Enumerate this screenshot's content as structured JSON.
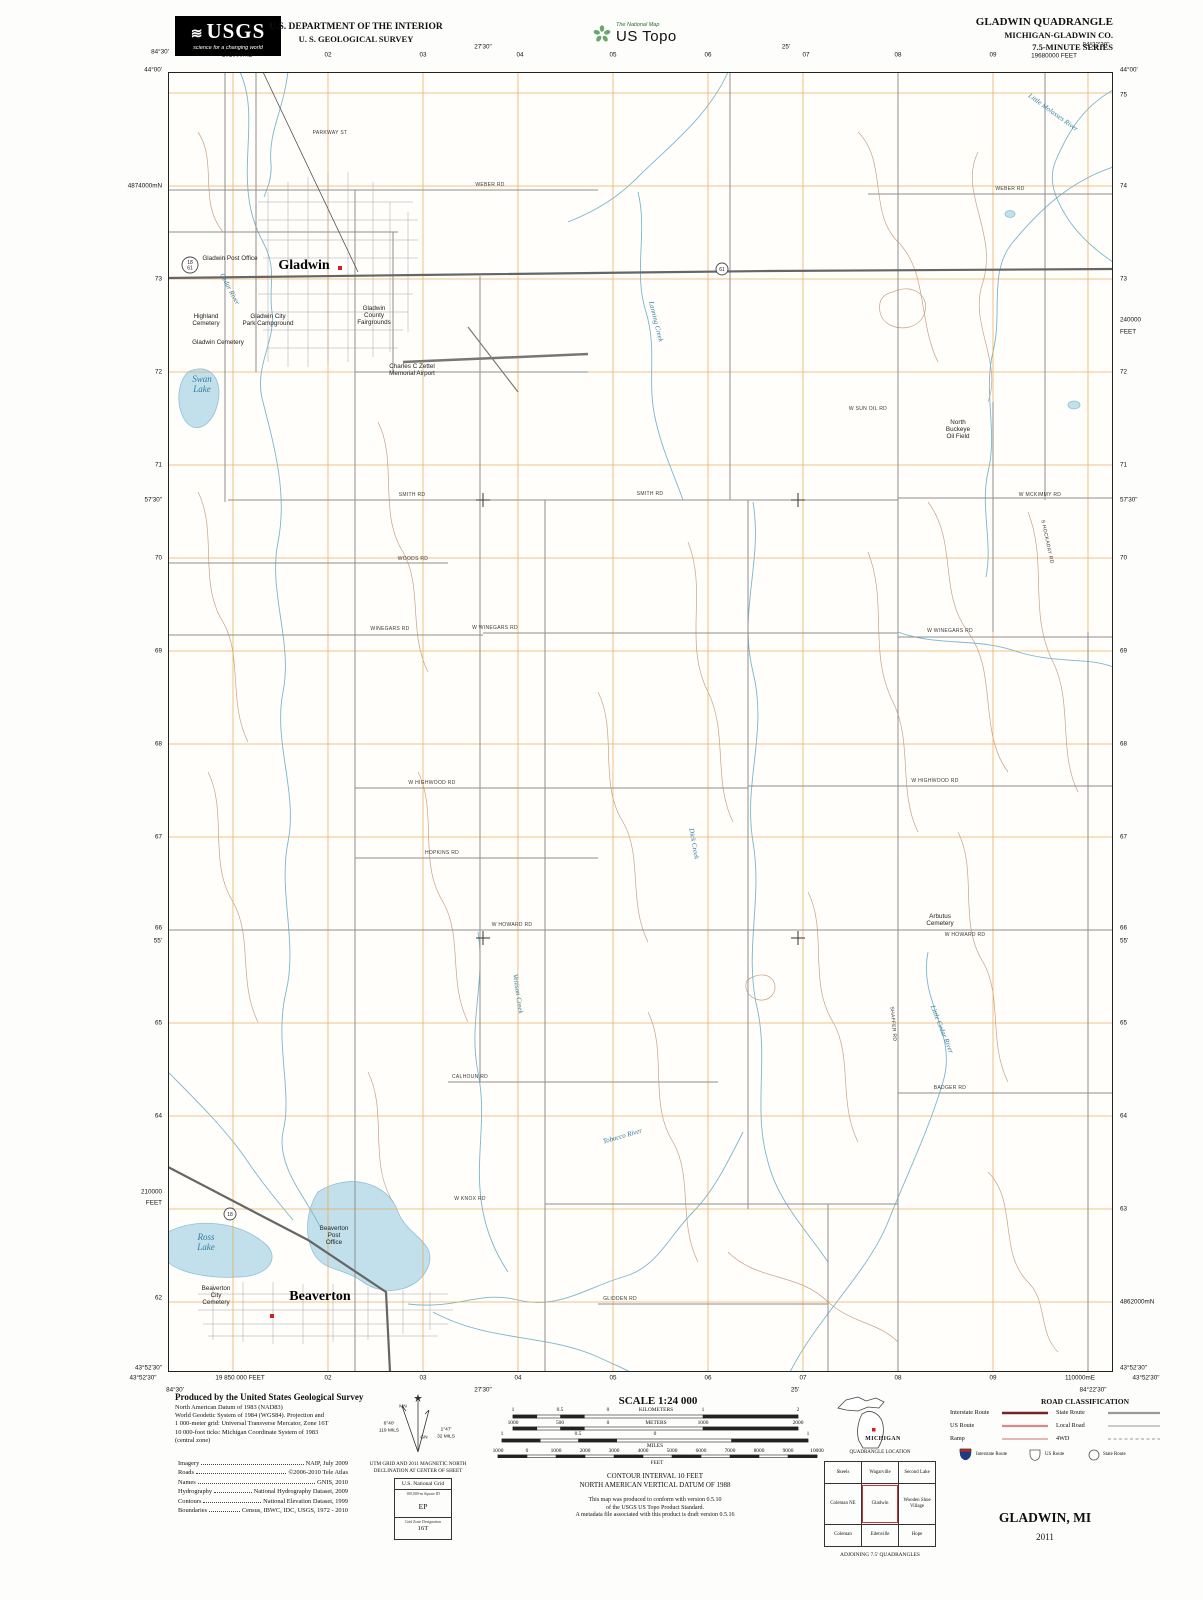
{
  "header": {
    "usgs": {
      "logo_text": "USGS",
      "tagline": "science for a changing world"
    },
    "dept_line1": "U.S. DEPARTMENT OF THE INTERIOR",
    "dept_line2": "U. S. GEOLOGICAL SURVEY",
    "ustopo": {
      "small": "The National Map",
      "large": "US Topo"
    },
    "title_block": {
      "line1": "GLADWIN QUADRANGLE",
      "line2": "MICHIGAN-GLADWIN CO.",
      "line3": "7.5-MINUTE SERIES"
    }
  },
  "map": {
    "edge_labels": {
      "top": [
        {
          "t": "84°30'",
          "x": 160,
          "y": 52
        },
        {
          "t": "101000mE",
          "x": 237,
          "y": 55
        },
        {
          "t": "02",
          "x": 328,
          "y": 55
        },
        {
          "t": "03",
          "x": 423,
          "y": 55
        },
        {
          "t": "27'30\"",
          "x": 483,
          "y": 47
        },
        {
          "t": "04",
          "x": 520,
          "y": 55
        },
        {
          "t": "05",
          "x": 613,
          "y": 55
        },
        {
          "t": "06",
          "x": 708,
          "y": 55
        },
        {
          "t": "25'",
          "x": 786,
          "y": 47
        },
        {
          "t": "07",
          "x": 806,
          "y": 55
        },
        {
          "t": "08",
          "x": 898,
          "y": 55
        },
        {
          "t": "09",
          "x": 993,
          "y": 55
        },
        {
          "t": "19680000 FEET",
          "x": 1054,
          "y": 56
        },
        {
          "t": "84°22'30\"",
          "x": 1096,
          "y": 45
        }
      ],
      "left": [
        {
          "t": "44°00'",
          "y": 70
        },
        {
          "t": "4874000mN",
          "y": 186
        },
        {
          "t": "73",
          "y": 279
        },
        {
          "t": "72",
          "y": 372
        },
        {
          "t": "71",
          "y": 465
        },
        {
          "t": "57'30\"",
          "y": 500
        },
        {
          "t": "70",
          "y": 558
        },
        {
          "t": "69",
          "y": 651
        },
        {
          "t": "68",
          "y": 744
        },
        {
          "t": "67",
          "y": 837
        },
        {
          "t": "66",
          "y": 928
        },
        {
          "t": "55'",
          "y": 941
        },
        {
          "t": "65",
          "y": 1023
        },
        {
          "t": "64",
          "y": 1116
        },
        {
          "t": "210000",
          "y": 1192
        },
        {
          "t": "FEET",
          "y": 1203
        },
        {
          "t": "62",
          "y": 1298
        },
        {
          "t": "43°52'30\"",
          "y": 1368
        }
      ],
      "right": [
        {
          "t": "44°00'",
          "y": 70
        },
        {
          "t": "75",
          "y": 95
        },
        {
          "t": "74",
          "y": 186
        },
        {
          "t": "73",
          "y": 279
        },
        {
          "t": "240000",
          "y": 320
        },
        {
          "t": "FEET",
          "y": 332
        },
        {
          "t": "72",
          "y": 372
        },
        {
          "t": "71",
          "y": 465
        },
        {
          "t": "57'30\"",
          "y": 500
        },
        {
          "t": "70",
          "y": 558
        },
        {
          "t": "69",
          "y": 651
        },
        {
          "t": "68",
          "y": 744
        },
        {
          "t": "67",
          "y": 837
        },
        {
          "t": "66",
          "y": 928
        },
        {
          "t": "55'",
          "y": 941
        },
        {
          "t": "65",
          "y": 1023
        },
        {
          "t": "64",
          "y": 1116
        },
        {
          "t": "63",
          "y": 1209
        },
        {
          "t": "4862000mN",
          "y": 1302
        },
        {
          "t": "43°52'30\"",
          "y": 1368
        }
      ],
      "bottom": [
        {
          "t": "43°52'30\"",
          "x": 143,
          "y": 1378
        },
        {
          "t": "19 850 000 FEET",
          "x": 240,
          "y": 1378
        },
        {
          "t": "02",
          "x": 328,
          "y": 1378
        },
        {
          "t": "03",
          "x": 423,
          "y": 1378
        },
        {
          "t": "04",
          "x": 518,
          "y": 1378
        },
        {
          "t": "05",
          "x": 613,
          "y": 1378
        },
        {
          "t": "06",
          "x": 708,
          "y": 1378
        },
        {
          "t": "07",
          "x": 803,
          "y": 1378
        },
        {
          "t": "08",
          "x": 898,
          "y": 1378
        },
        {
          "t": "09",
          "x": 993,
          "y": 1378
        },
        {
          "t": "110000mE",
          "x": 1080,
          "y": 1378
        },
        {
          "t": "43°52'30\"",
          "x": 1146,
          "y": 1378
        },
        {
          "t": "84°30'",
          "x": 175,
          "y": 1390
        },
        {
          "t": "27'30\"",
          "x": 483,
          "y": 1390
        },
        {
          "t": "25'",
          "x": 795,
          "y": 1390
        },
        {
          "t": "84°22'30\"",
          "x": 1093,
          "y": 1390
        }
      ]
    },
    "labels": [
      {
        "t": "Gladwin",
        "x": 136,
        "y": 197,
        "c": "town"
      },
      {
        "t": "Beaverton",
        "x": 152,
        "y": 1228,
        "c": "town"
      },
      {
        "t": "Gladwin Post Office",
        "x": 62,
        "y": 188
      },
      {
        "t": "Highland\nCemetery",
        "x": 38,
        "y": 246
      },
      {
        "t": "Gladwin City\nPark Campground",
        "x": 100,
        "y": 246
      },
      {
        "t": "Gladwin Cemetery",
        "x": 50,
        "y": 272
      },
      {
        "t": "Gladwin\nCounty\nFairgrounds",
        "x": 206,
        "y": 238
      },
      {
        "t": "Charles C Zettel\nMemorial Airport",
        "x": 244,
        "y": 296
      },
      {
        "t": "North\nBuckeye\nOil Field",
        "x": 790,
        "y": 352
      },
      {
        "t": "Arbutus\nCemetery",
        "x": 772,
        "y": 846
      },
      {
        "t": "Beaverton\nPost\nOffice",
        "x": 166,
        "y": 1158
      },
      {
        "t": "Beaverton\nCity\nCemetery",
        "x": 48,
        "y": 1218
      },
      {
        "t": "Swan\nLake",
        "x": 34,
        "y": 310,
        "c": "waterbig"
      },
      {
        "t": "Ross\nLake",
        "x": 38,
        "y": 1168,
        "c": "waterbig"
      },
      {
        "t": "Cedar River",
        "x": 60,
        "y": 218,
        "c": "water",
        "r": 62
      },
      {
        "t": "Little Cedar River",
        "x": 772,
        "y": 958,
        "c": "water",
        "r": 68
      },
      {
        "t": "Tobacco River",
        "x": 455,
        "y": 1066,
        "c": "water",
        "r": -16
      },
      {
        "t": "Little Molasses River",
        "x": 884,
        "y": 42,
        "c": "water",
        "r": 36
      },
      {
        "t": "Dick Creek",
        "x": 524,
        "y": 772,
        "c": "water",
        "r": 80
      },
      {
        "t": "Venison Creek",
        "x": 348,
        "y": 922,
        "c": "water",
        "r": 82
      },
      {
        "t": "Lanning Creek",
        "x": 486,
        "y": 250,
        "c": "water",
        "r": 76
      },
      {
        "t": "SMITH RD",
        "x": 244,
        "y": 424,
        "c": "road"
      },
      {
        "t": "SMITH RD",
        "x": 482,
        "y": 423,
        "c": "road"
      },
      {
        "t": "W MCKIMMY RD",
        "x": 872,
        "y": 424,
        "c": "road"
      },
      {
        "t": "WOODS RD",
        "x": 245,
        "y": 488,
        "c": "road"
      },
      {
        "t": "WINEGARS RD",
        "x": 222,
        "y": 558,
        "c": "road"
      },
      {
        "t": "W WINEGARS RD",
        "x": 327,
        "y": 557,
        "c": "road"
      },
      {
        "t": "W WINEGARS RD",
        "x": 782,
        "y": 560,
        "c": "road"
      },
      {
        "t": "W HIGHWOOD RD",
        "x": 264,
        "y": 712,
        "c": "road"
      },
      {
        "t": "W HIGHWOOD RD",
        "x": 767,
        "y": 710,
        "c": "road"
      },
      {
        "t": "HOPKINS RD",
        "x": 274,
        "y": 782,
        "c": "road"
      },
      {
        "t": "W HOWARD RD",
        "x": 344,
        "y": 854,
        "c": "road"
      },
      {
        "t": "W HOWARD RD",
        "x": 797,
        "y": 864,
        "c": "road"
      },
      {
        "t": "CALHOUN RD",
        "x": 302,
        "y": 1006,
        "c": "road"
      },
      {
        "t": "W KNOX RD",
        "x": 302,
        "y": 1128,
        "c": "road"
      },
      {
        "t": "GLIDDEN RD",
        "x": 452,
        "y": 1228,
        "c": "road"
      },
      {
        "t": "BADGER RD",
        "x": 782,
        "y": 1017,
        "c": "road"
      },
      {
        "t": "WEBER RD",
        "x": 322,
        "y": 114,
        "c": "road"
      },
      {
        "t": "WEBER RD",
        "x": 842,
        "y": 118,
        "c": "road"
      },
      {
        "t": "PARKWAY ST",
        "x": 162,
        "y": 62,
        "c": "road"
      },
      {
        "t": "W SUN OIL RD",
        "x": 700,
        "y": 338,
        "c": "road"
      },
      {
        "t": "S HOCKADAY RD",
        "x": 878,
        "y": 470,
        "c": "road",
        "r": 78
      },
      {
        "t": "SHAFFER RD",
        "x": 724,
        "y": 952,
        "c": "road",
        "r": 85
      },
      {
        "t": "18\n61",
        "x": 22,
        "y": 192,
        "c": "shield"
      },
      {
        "t": "61",
        "x": 554,
        "y": 199,
        "c": "shield"
      },
      {
        "t": "18",
        "x": 62,
        "y": 1144,
        "c": "shield"
      }
    ]
  },
  "footer": {
    "produced": {
      "title": "Produced by the United States Geological Survey",
      "lines": [
        "North American Datum of 1983 (NAD83)",
        "World Geodetic System of 1984 (WGS84).  Projection and",
        "1 000-meter grid: Universal Transverse Mercator, Zone 16T",
        "10 000-foot ticks: Michigan Coordinate System of 1983",
        "(central zone)"
      ]
    },
    "credits": [
      {
        "label": "Imagery",
        "value": "NAIP, July 2009"
      },
      {
        "label": "Roads",
        "value": "©2006-2010 Tele Atlas"
      },
      {
        "label": "Names",
        "value": "GNIS, 2010"
      },
      {
        "label": "Hydrography",
        "value": "National Hydrography Dataset, 2009"
      },
      {
        "label": "Contours",
        "value": "National Elevation Dataset, 1999"
      },
      {
        "label": "Boundaries",
        "value": "Census, IBWC, IDC, USGS, 1972 - 2010"
      }
    ],
    "fl": [
      {
        "t": "MN",
        "x": 403,
        "y": 1407
      },
      {
        "t": "6°40'",
        "x": 389,
        "y": 1424
      },
      {
        "t": "119 MILS",
        "x": 389,
        "y": 1431
      },
      {
        "t": "GN",
        "x": 424,
        "y": 1438
      },
      {
        "t": "1°47'",
        "x": 446,
        "y": 1430
      },
      {
        "t": "32 MILS",
        "x": 446,
        "y": 1437
      }
    ],
    "declination_caption1": "UTM GRID AND 2011 MAGNETIC NORTH",
    "declination_caption2": "DECLINATION AT CENTER OF SHEET",
    "usng": {
      "title": "U.S. National Grid",
      "sub1": "100,000-m Square ID",
      "square_id": "EP",
      "sub2": "Grid Zone Designation",
      "zone": "16T"
    },
    "scale": {
      "title": "SCALE 1:24 000",
      "rows": [
        {
          "y": 1410,
          "ticks": [
            {
              "t": "1",
              "x": 513
            },
            {
              "t": "0.5",
              "x": 560
            },
            {
              "t": "0",
              "x": 608
            },
            {
              "t": "KILOMETERS",
              "x": 656
            },
            {
              "t": "1",
              "x": 703
            },
            {
              "t": "2",
              "x": 798
            }
          ]
        },
        {
          "y": 1423,
          "ticks": [
            {
              "t": "1000",
              "x": 513
            },
            {
              "t": "500",
              "x": 560
            },
            {
              "t": "0",
              "x": 608
            },
            {
              "t": "METERS",
              "x": 656
            },
            {
              "t": "1000",
              "x": 703
            },
            {
              "t": "2000",
              "x": 798
            }
          ]
        },
        {
          "y": 1434,
          "ticks": [
            {
              "t": "1",
              "x": 502
            },
            {
              "t": "0.5",
              "x": 578
            },
            {
              "t": "0",
              "x": 655
            },
            {
              "t": "1",
              "x": 808
            }
          ]
        },
        {
          "y": 1446,
          "ticks": [
            {
              "t": "MILES",
              "x": 655
            }
          ]
        },
        {
          "y": 1451,
          "ticks": [
            {
              "t": "1000",
              "x": 498
            },
            {
              "t": "0",
              "x": 527
            },
            {
              "t": "1000",
              "x": 556
            },
            {
              "t": "2000",
              "x": 585
            },
            {
              "t": "3000",
              "x": 614
            },
            {
              "t": "4000",
              "x": 643
            },
            {
              "t": "5000",
              "x": 672
            },
            {
              "t": "6000",
              "x": 701
            },
            {
              "t": "7000",
              "x": 730
            },
            {
              "t": "8000",
              "x": 759
            },
            {
              "t": "9000",
              "x": 788
            },
            {
              "t": "10000",
              "x": 817
            }
          ]
        },
        {
          "y": 1463,
          "ticks": [
            {
              "t": "FEET",
              "x": 657
            }
          ]
        }
      ]
    },
    "contour_note1": "CONTOUR INTERVAL 10 FEET",
    "contour_note2": "NORTH AMERICAN VERTICAL DATUM OF 1988",
    "conformance": [
      "This map was produced to conform with version 0.5.10",
      "of the USGS US Topo Product Standard.",
      "A metadata file associated with this product is draft version 0.5.16"
    ],
    "state_map": {
      "label": "MICHIGAN",
      "caption": "QUADRANGLE LOCATION"
    },
    "adjoining": {
      "cells": [
        "Skeels",
        "Wagarville",
        "Second Lake",
        "Coleman NE",
        "Gladwin",
        "Wooden Shoe Village",
        "Coleman",
        "Edenville",
        "Hope"
      ],
      "caption": "ADJOINING 7.5' QUADRANGLES"
    },
    "road_class": {
      "title": "ROAD CLASSIFICATION",
      "left_rows": [
        "Interstate Route",
        "US Route",
        "Ramp"
      ],
      "right_rows": [
        "State Route",
        "Local Road",
        "4WD"
      ],
      "shield_labels": [
        "Interstate Route",
        "US Route",
        "State Route"
      ]
    },
    "sheet": {
      "name": "GLADWIN, MI",
      "year": "2011"
    }
  },
  "colors": {
    "grid_orange": "#e8a44c",
    "road_gray": "#8f8f8f",
    "highway_gray": "#666666",
    "water_line": "#7ab6ce",
    "water_fill": "#c2e0ec",
    "contour_tan": "#c9a183",
    "interstate_red": "#7a2128",
    "us_route_pink": "#d98b8b",
    "building_red": "#cc2222"
  }
}
